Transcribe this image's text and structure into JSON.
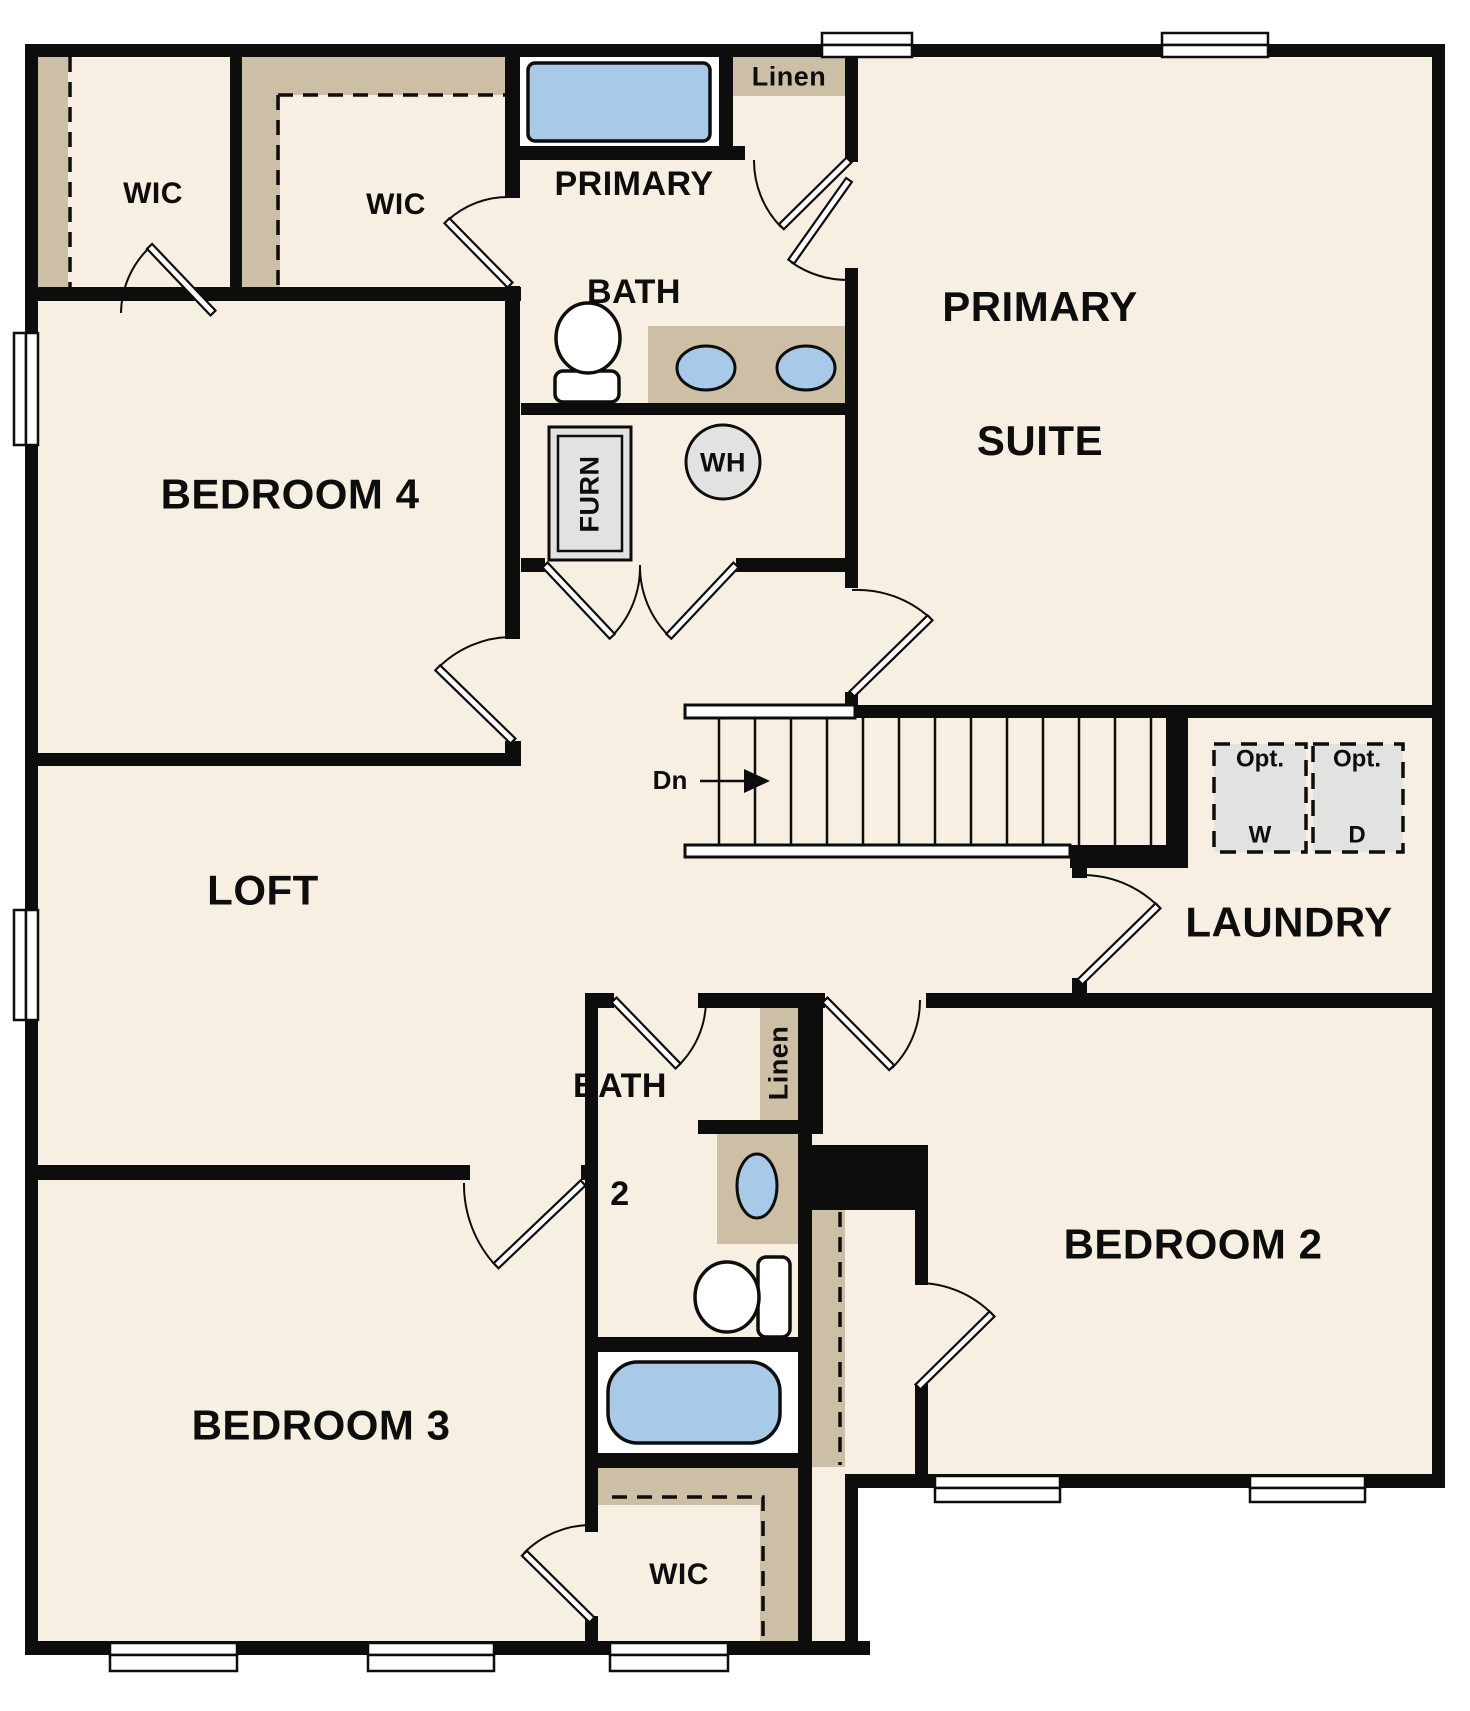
{
  "floor_plan": {
    "labels": {
      "wic_top_left": "WIC",
      "wic_top_mid": "WIC",
      "primary_bath": [
        "PRIMARY",
        "BATH"
      ],
      "linen_top": "Linen",
      "primary_suite": [
        "PRIMARY",
        "SUITE"
      ],
      "bedroom4": "BEDROOM 4",
      "furnace": "FURN",
      "water_heater": "WH",
      "stairs_down": "Dn",
      "opt_washer": [
        "Opt.",
        "W"
      ],
      "opt_dryer": [
        "Opt.",
        "D"
      ],
      "laundry": "LAUNDRY",
      "loft": "LOFT",
      "bath2": [
        "BATH",
        "2"
      ],
      "linen_bath2": "Linen",
      "bedroom2": "BEDROOM 2",
      "bedroom3": "BEDROOM 3",
      "wic_bottom": "WIC"
    },
    "fixtures": [
      "bathtub",
      "soaking-tub",
      "toilet",
      "double-sink-vanity",
      "single-sink-vanity",
      "furnace",
      "water-heater",
      "optional-washer",
      "optional-dryer",
      "staircase-down",
      "window",
      "door-swing",
      "closet-shelving"
    ],
    "colors": {
      "wall": "#0d0d0d",
      "floor": "#f7efe2",
      "closet_tan": "#cdbfa5",
      "fixture_blue": "#a9c9e9",
      "appliance_gray": "#e2e2e0",
      "window_white": "#ffffff"
    }
  }
}
